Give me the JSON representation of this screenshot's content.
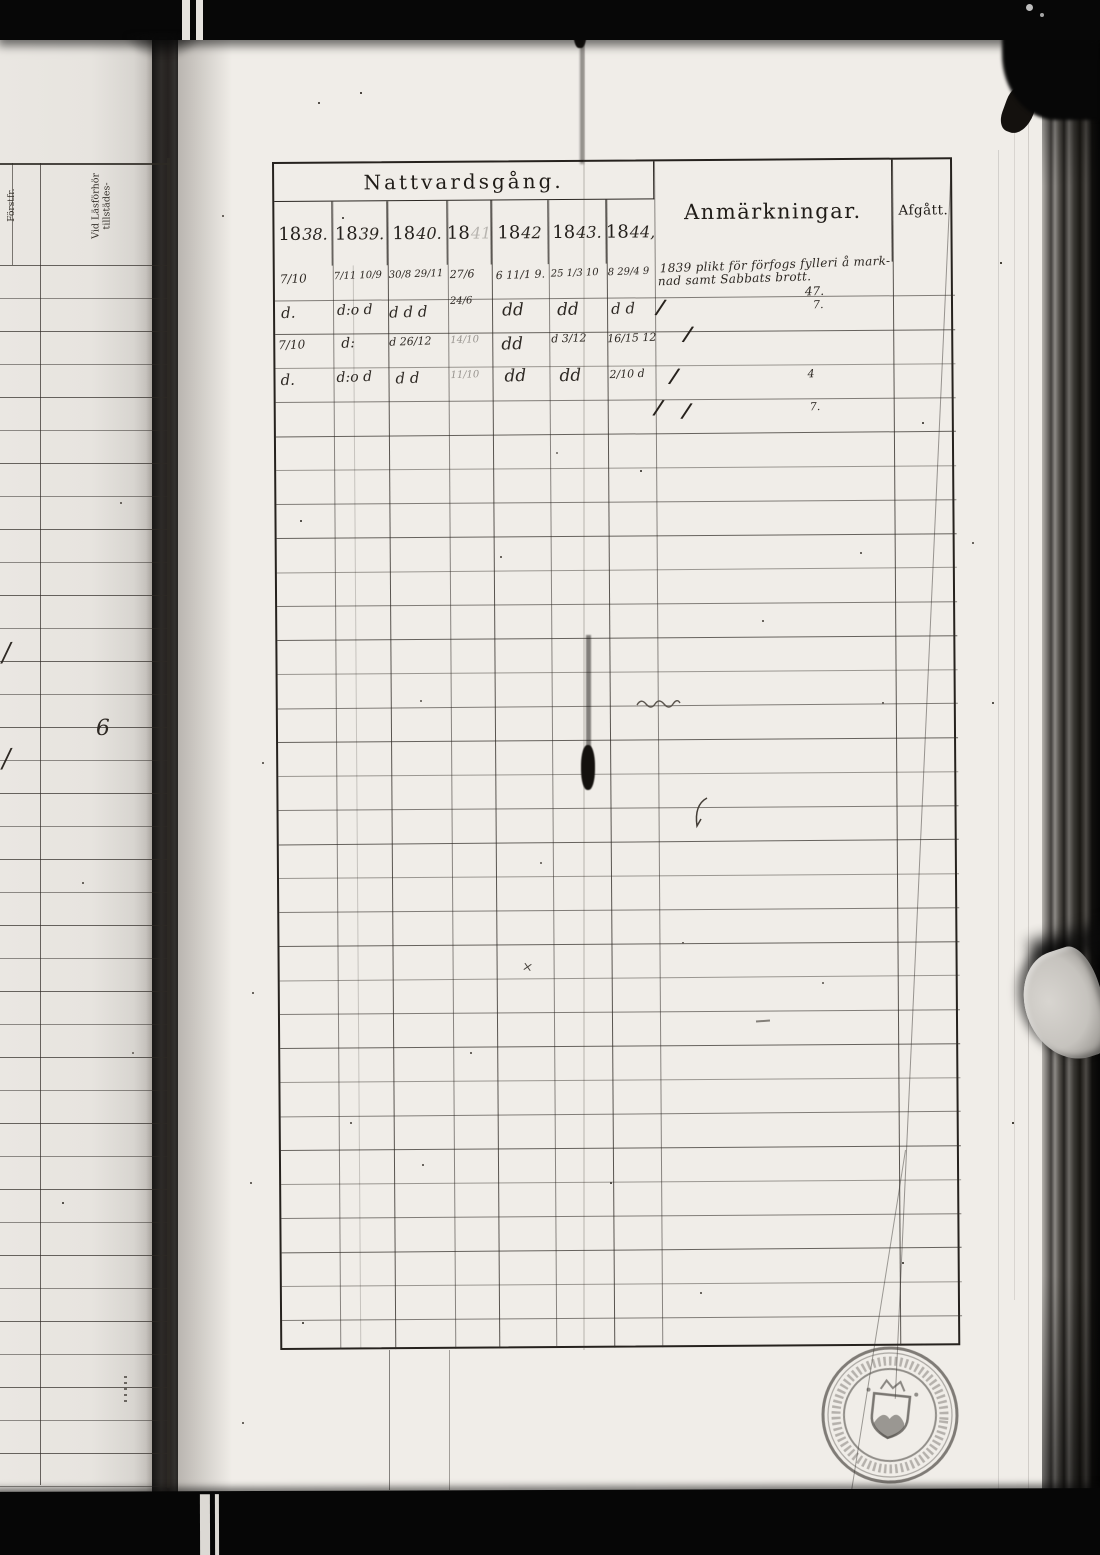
{
  "main_table": {
    "title": "Nattvardsgång.",
    "remarks_header": "Anmärkningar.",
    "departed_header": "Afgått.",
    "years": [
      {
        "printed": "18",
        "script": "38."
      },
      {
        "printed": "18",
        "script": "39."
      },
      {
        "printed": "18",
        "script": "40."
      },
      {
        "printed": "18",
        "script": "41"
      },
      {
        "printed": "18",
        "script": "42"
      },
      {
        "printed": "18",
        "script": "43."
      },
      {
        "printed": "18",
        "script": "44,"
      }
    ],
    "entries": [
      {
        "r": 1,
        "c": "c0",
        "t": "7/10",
        "dx": 5,
        "dy": 6,
        "fs": 12
      },
      {
        "r": 1,
        "c": "c1",
        "t": "7/11 10/9",
        "dx": 1,
        "dy": 5,
        "fs": 10
      },
      {
        "r": 1,
        "c": "c2",
        "t": "30/8 29/11",
        "dx": 1,
        "dy": 4,
        "fs": 10
      },
      {
        "r": 1,
        "c": "c3",
        "t": "27/6",
        "dx": 2,
        "dy": 3,
        "fs": 11
      },
      {
        "r": 1,
        "c": "c4",
        "t": "6 11/1 9.",
        "dx": 4,
        "dy": 4,
        "fs": 11
      },
      {
        "r": 1,
        "c": "c5",
        "t": "25 1/3 10",
        "dx": 2,
        "dy": 4,
        "fs": 10
      },
      {
        "r": 1,
        "c": "c6",
        "t": "8 29/4 9",
        "dx": 1,
        "dy": 3,
        "fs": 10
      },
      {
        "r": 1,
        "c": "rem",
        "t": "1839 plikt för förfogs fylleri å mark-",
        "dx": 3,
        "dy": -5,
        "fs": 12,
        "cls": "rm"
      },
      {
        "r": 1,
        "c": "rem",
        "t": "nad samt Sabbats brott.",
        "dx": 1,
        "dy": 9,
        "fs": 12,
        "cls": "rm"
      },
      {
        "r": 1,
        "c": "rem",
        "t": "47.",
        "dx": 148,
        "dy": 22,
        "fs": 12
      },
      {
        "r": 2,
        "c": "c0",
        "t": "d.",
        "dx": 6,
        "dy": 4,
        "fs": 15
      },
      {
        "r": 2,
        "c": "c1",
        "t": "d:o d",
        "dx": 4,
        "dy": 3,
        "fs": 14
      },
      {
        "r": 2,
        "c": "c2",
        "t": "d d d",
        "dx": 1,
        "dy": 4,
        "fs": 15
      },
      {
        "r": 2,
        "c": "c3",
        "t": "24/6",
        "dx": 2,
        "dy": -3,
        "fs": 10
      },
      {
        "r": 2,
        "c": "c4",
        "t": "dd",
        "dx": 10,
        "dy": 2,
        "fs": 17
      },
      {
        "r": 2,
        "c": "c5",
        "t": "dd",
        "dx": 8,
        "dy": 2,
        "fs": 17
      },
      {
        "r": 2,
        "c": "c6",
        "t": "d d",
        "dx": 4,
        "dy": 2,
        "fs": 15
      },
      {
        "r": 2,
        "c": "rem",
        "t": "/",
        "dx": 0,
        "dy": -2,
        "fs": 20,
        "cls": "slash"
      },
      {
        "r": 2,
        "c": "rem",
        "t": "7.",
        "dx": 156,
        "dy": 2,
        "fs": 11
      },
      {
        "r": 3,
        "c": "c0",
        "t": "7/10",
        "dx": 3,
        "dy": 4,
        "fs": 12
      },
      {
        "r": 3,
        "c": "c1",
        "t": "d:",
        "dx": 8,
        "dy": 2,
        "fs": 14
      },
      {
        "r": 3,
        "c": "c2",
        "t": "d 26/12",
        "dx": 1,
        "dy": 2,
        "fs": 11
      },
      {
        "r": 3,
        "c": "c3",
        "t": "14/10",
        "dx": 2,
        "dy": 2,
        "fs": 10,
        "cls": "faint"
      },
      {
        "r": 3,
        "c": "c4",
        "t": "dd",
        "dx": 9,
        "dy": 2,
        "fs": 17
      },
      {
        "r": 3,
        "c": "c5",
        "t": "d 3/12",
        "dx": 2,
        "dy": 0,
        "fs": 11
      },
      {
        "r": 3,
        "c": "c6",
        "t": "16/15 12",
        "dx": 0,
        "dy": 0,
        "fs": 11
      },
      {
        "r": 3,
        "c": "rem",
        "t": "/",
        "dx": 27,
        "dy": -9,
        "fs": 20,
        "cls": "slash"
      },
      {
        "r": 4,
        "c": "c0",
        "t": "d.",
        "dx": 5,
        "dy": 3,
        "fs": 15
      },
      {
        "r": 4,
        "c": "c1",
        "t": "d:o d",
        "dx": 3,
        "dy": 2,
        "fs": 14
      },
      {
        "r": 4,
        "c": "c2",
        "t": "d d",
        "dx": 7,
        "dy": 2,
        "fs": 15
      },
      {
        "r": 4,
        "c": "c3",
        "t": "11/10",
        "dx": 2,
        "dy": 3,
        "fs": 10,
        "cls": "faint"
      },
      {
        "r": 4,
        "c": "c4",
        "t": "dd",
        "dx": 12,
        "dy": 0,
        "fs": 17
      },
      {
        "r": 4,
        "c": "c5",
        "t": "dd",
        "dx": 10,
        "dy": 0,
        "fs": 17
      },
      {
        "r": 4,
        "c": "c6",
        "t": "2/10 d",
        "dx": 2,
        "dy": 2,
        "fs": 11
      },
      {
        "r": 4,
        "c": "rem",
        "t": "/",
        "dx": 13,
        "dy": -1,
        "fs": 20,
        "cls": "slash"
      },
      {
        "r": 4,
        "c": "rem",
        "t": "4",
        "dx": 150,
        "dy": 3,
        "fs": 11
      },
      {
        "r": 5,
        "c": "rem",
        "t": "/ /",
        "dx": -3,
        "dy": -2,
        "fs": 20,
        "cls": "slash"
      },
      {
        "r": 5,
        "c": "rem",
        "t": "7.",
        "dx": 152,
        "dy": 2,
        "fs": 11
      }
    ]
  },
  "left_page": {
    "column_headers": [
      "Förstfr.",
      "Vid Läsförhör tillstädes-"
    ],
    "marks": [
      {
        "t": "/",
        "x": 2,
        "y": 638,
        "fs": 26
      },
      {
        "t": "/",
        "x": 2,
        "y": 744,
        "fs": 26
      },
      {
        "t": "6",
        "x": 96,
        "y": 716,
        "fs": 22
      }
    ]
  }
}
